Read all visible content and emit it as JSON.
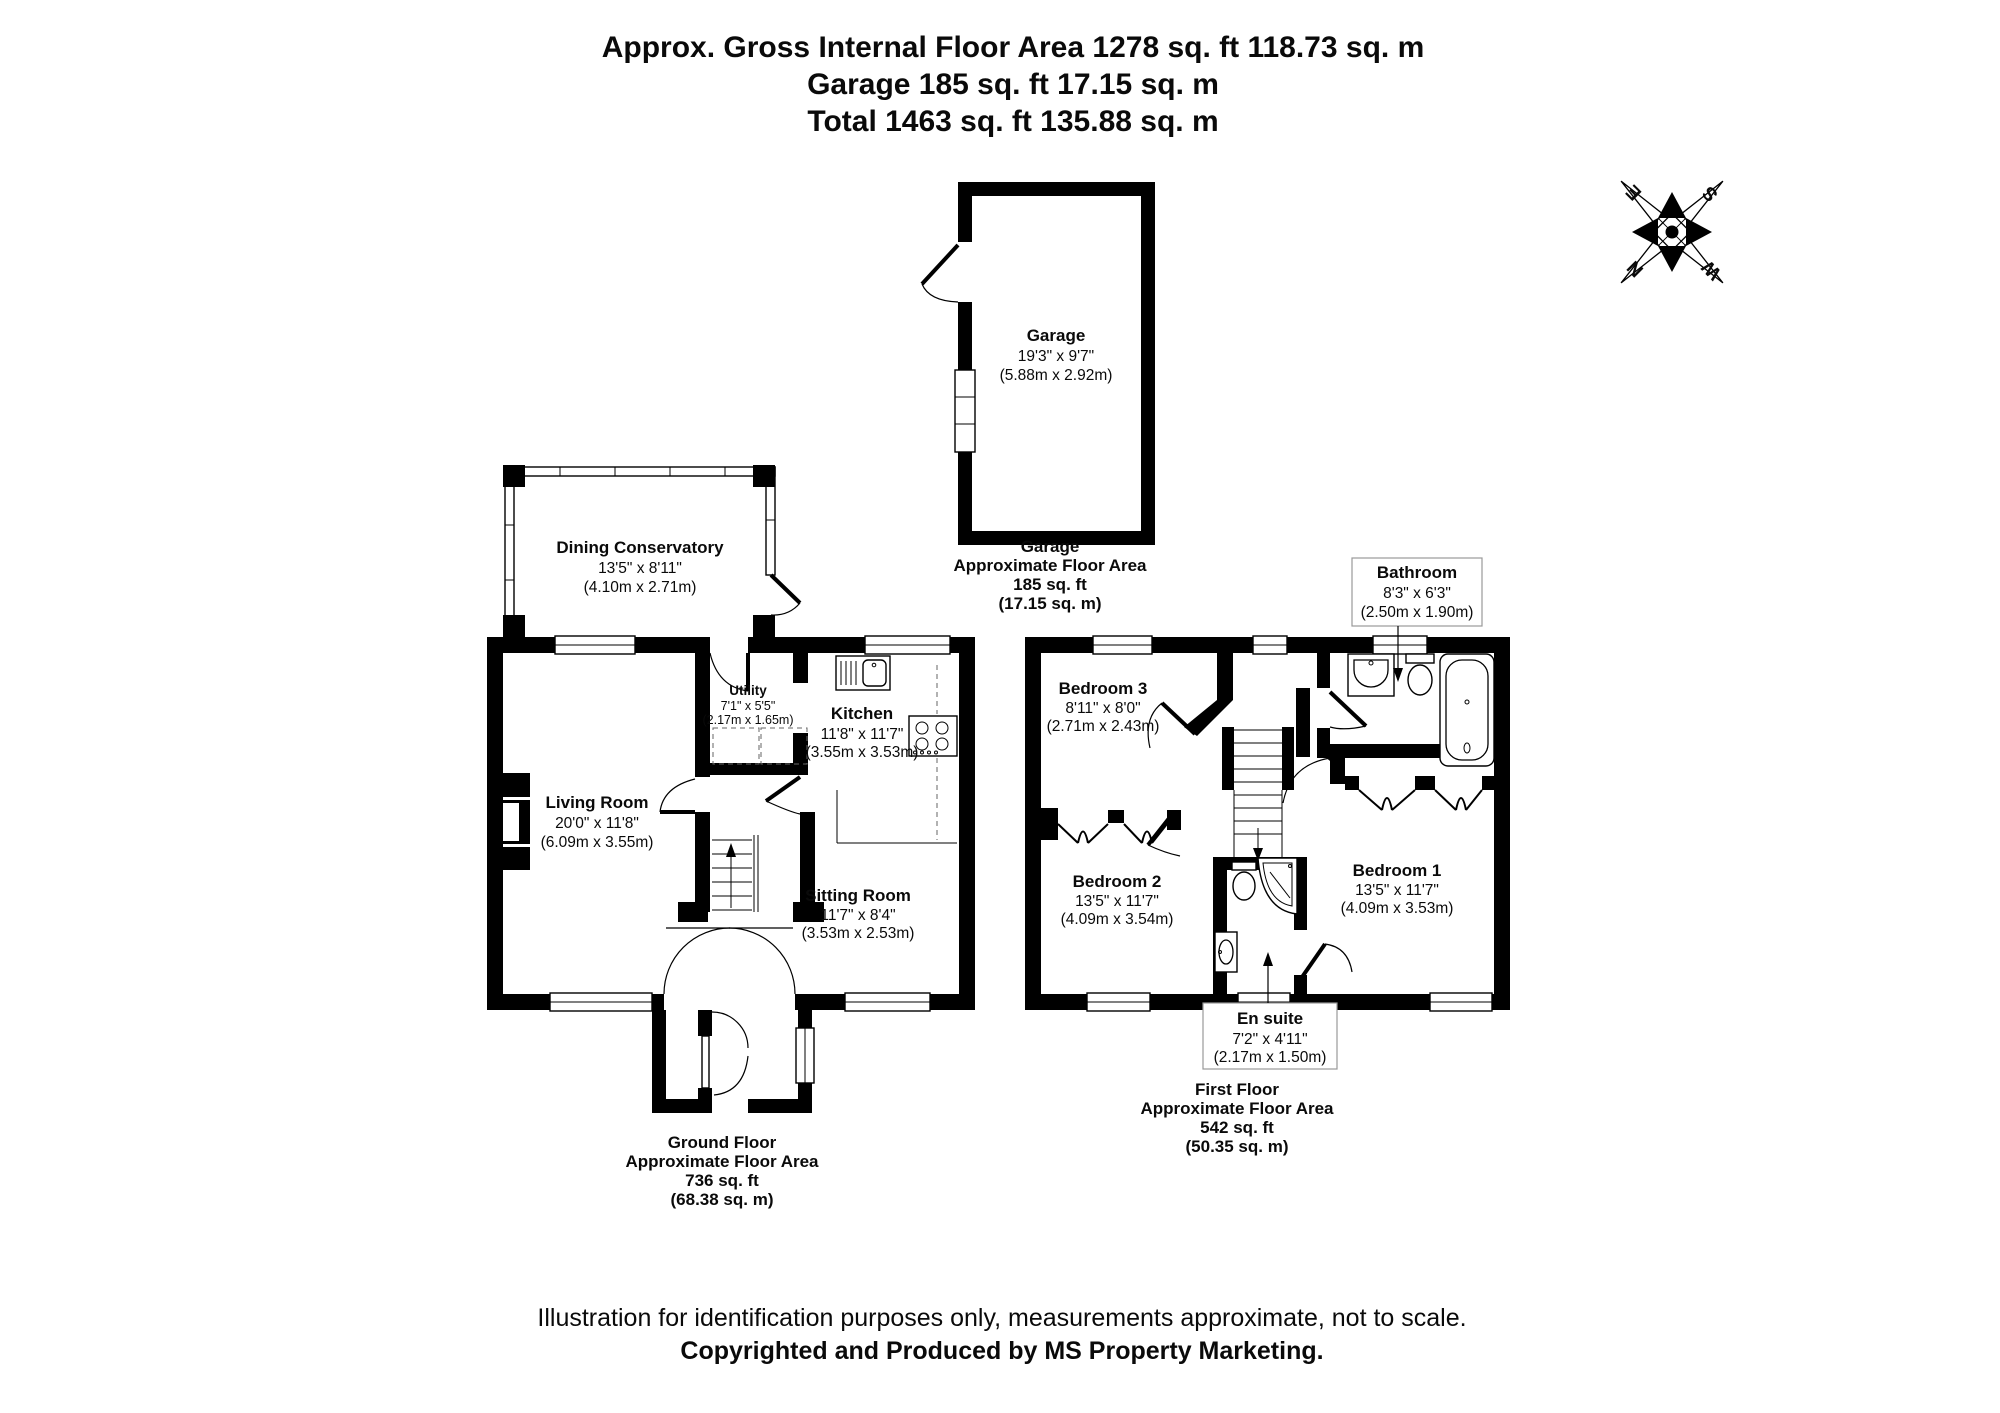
{
  "header": {
    "line1": "Approx. Gross Internal Floor Area 1278 sq. ft 118.73 sq. m",
    "line2": "Garage 185 sq. ft 17.15 sq. m",
    "line3": "Total 1463 sq. ft 135.88 sq. m"
  },
  "garage": {
    "room": {
      "name": "Garage",
      "imperial": "19'3\" x 9'7\"",
      "metric": "(5.88m x 2.92m)"
    },
    "area": {
      "title": "Garage",
      "subtitle": "Approximate Floor Area",
      "imperial": "185 sq. ft",
      "metric": "(17.15 sq. m)"
    }
  },
  "ground_floor": {
    "rooms": {
      "dining_conservatory": {
        "name": "Dining Conservatory",
        "imperial": "13'5\" x 8'11\"",
        "metric": "(4.10m x 2.71m)"
      },
      "living_room": {
        "name": "Living Room",
        "imperial": "20'0\" x 11'8\"",
        "metric": "(6.09m x 3.55m)"
      },
      "utility": {
        "name": "Utility",
        "imperial": "7'1\" x 5'5\"",
        "metric": "(2.17m x 1.65m)"
      },
      "kitchen": {
        "name": "Kitchen",
        "imperial": "11'8\" x 11'7\"",
        "metric": "(3.55m x 3.53m)"
      },
      "sitting_room": {
        "name": "Sitting Room",
        "imperial": "11'7\" x 8'4\"",
        "metric": "(3.53m x 2.53m)"
      }
    },
    "area": {
      "title": "Ground Floor",
      "subtitle": "Approximate Floor Area",
      "imperial": "736 sq. ft",
      "metric": "(68.38 sq. m)"
    }
  },
  "first_floor": {
    "rooms": {
      "bedroom_3": {
        "name": "Bedroom 3",
        "imperial": "8'11\" x 8'0\"",
        "metric": "(2.71m x 2.43m)"
      },
      "bedroom_2": {
        "name": "Bedroom 2",
        "imperial": "13'5\" x 11'7\"",
        "metric": "(4.09m x 3.54m)"
      },
      "bedroom_1": {
        "name": "Bedroom 1",
        "imperial": "13'5\" x 11'7\"",
        "metric": "(4.09m x 3.53m)"
      },
      "bathroom": {
        "name": "Bathroom",
        "imperial": "8'3\" x 6'3\"",
        "metric": "(2.50m x 1.90m)"
      },
      "en_suite": {
        "name": "En suite",
        "imperial": "7'2\" x 4'11\"",
        "metric": "(2.17m x 1.50m)"
      }
    },
    "area": {
      "title": "First Floor",
      "subtitle": "Approximate Floor Area",
      "imperial": "542 sq. ft",
      "metric": "(50.35 sq. m)"
    }
  },
  "compass": {
    "north": "N",
    "east": "E",
    "south": "S",
    "west": "W"
  },
  "disclaimer": {
    "line1": "Illustration for identification purposes only, measurements approximate, not to scale.",
    "line2": "Copyrighted  and Produced by MS Property Marketing."
  },
  "colors": {
    "wall": "#000000",
    "background": "#ffffff"
  }
}
